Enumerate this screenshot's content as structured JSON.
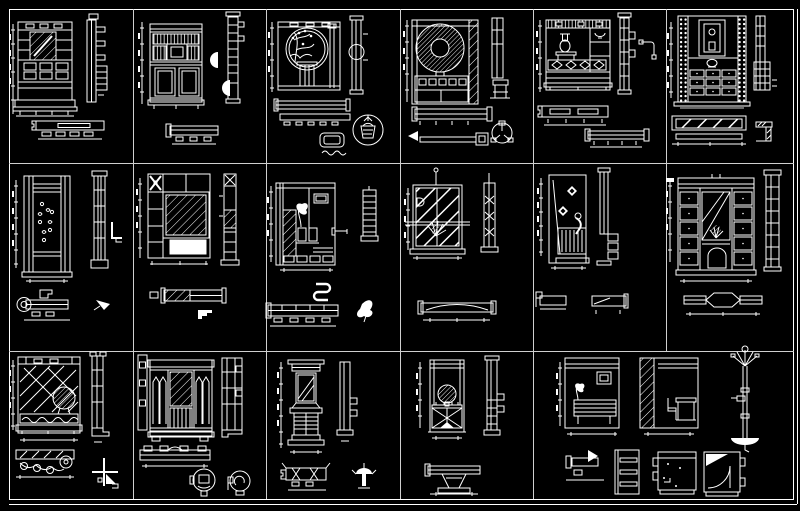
{
  "canvas": {
    "type": "CAD block library sheet",
    "background_color": "#000000",
    "line_color": "#ffffff",
    "grid_line_color": "#cfcfcf",
    "description": "Dark CAD sheet showing a grid of interior joinery blocks: cabinet and screen elevations, side sections, plan views and small fitting details drawn in white line-work"
  },
  "grid": {
    "rows": 3,
    "columns": 6,
    "merged_cells": "last cell of row 3 spans two columns",
    "cell_count": 17
  },
  "cells": [
    {
      "id": "r1c1",
      "row": 1,
      "col": 1,
      "label": "Wardrobe elevation with hatched mirror panel and drawer stack, side section, plan"
    },
    {
      "id": "r1c2",
      "row": 1,
      "col": 2,
      "label": "Louvered sideboard with framed centre tile and twin dark doors, side section, two semicircle details, plan"
    },
    {
      "id": "r1c3",
      "row": 1,
      "col": 3,
      "label": "Moon-gate display panel with plant and pedestal, side section, two plan strips, basket roundel detail"
    },
    {
      "id": "r1c4",
      "row": 1,
      "col": 4,
      "label": "Dresser with round wreath ornament and hatched stile, side section, rod detail, fan roundel"
    },
    {
      "id": "r1c5",
      "row": 1,
      "col": 5,
      "label": "Display shelf with vase and fretwork band, side section with pipe bracket, two plan strips"
    },
    {
      "id": "r1c6",
      "row": 1,
      "col": 6,
      "label": "Tall cabinet with display niche and nine drawers, stippled stiles, side section, hatched plan band, corner detail"
    },
    {
      "id": "r2c1",
      "row": 2,
      "col": 1,
      "label": "Decorative door panel with floral motifs, side section, bracket detail, column plan with circle"
    },
    {
      "id": "r2c2",
      "row": 2,
      "col": 2,
      "label": "Cabinet with bow-tie motif and diagonally hatched mirror, side section, half-hatched plan, stepped detail"
    },
    {
      "id": "r2c3",
      "row": 2,
      "col": 3,
      "label": "Feature wall with plant, hatch strip and twin dark niches, ladder section, scroll ribbon, segmented plan"
    },
    {
      "id": "r2c4",
      "row": 2,
      "col": 4,
      "label": "Glazed screen with wide diagonal hatch, grass tuft and through rail, side section, bowed plan"
    },
    {
      "id": "r2c5",
      "row": 2,
      "col": 5,
      "label": "Narrow panel with tilted tiles and radiator grille, side section, two plan fragments"
    },
    {
      "id": "r2c6",
      "row": 2,
      "col": 6,
      "label": "Wardrobe with sash mirror, arched centre door and twin drawer banks, side section, hexagon-bulge plan"
    },
    {
      "id": "r3c1",
      "row": 3,
      "col": 1,
      "label": "Garden trellis screen with shrub and scroll band, side post, lattice fence plan, corner bracket detail"
    },
    {
      "id": "r3c2",
      "row": 3,
      "col": 2,
      "label": "Classical wardrobe with lancet glazed doors and hatched mirror, side section, pilaster plan, two roundel details"
    },
    {
      "id": "r3c3",
      "row": 3,
      "col": 3,
      "label": "Hall stand with mirror and slatted locker, side section, bench plan with braces, palm finial detail"
    },
    {
      "id": "r3c4",
      "row": 3,
      "col": 4,
      "label": "Open plant stand over X-braced cabinet, side section, funnel plan detail"
    },
    {
      "id": "r3c5",
      "row": 3,
      "col": 5,
      "label": "Two wall-panel elevations with bench and desk, coat stand, shelf side ladder, dotted cabinet and door-swing details"
    }
  ]
}
